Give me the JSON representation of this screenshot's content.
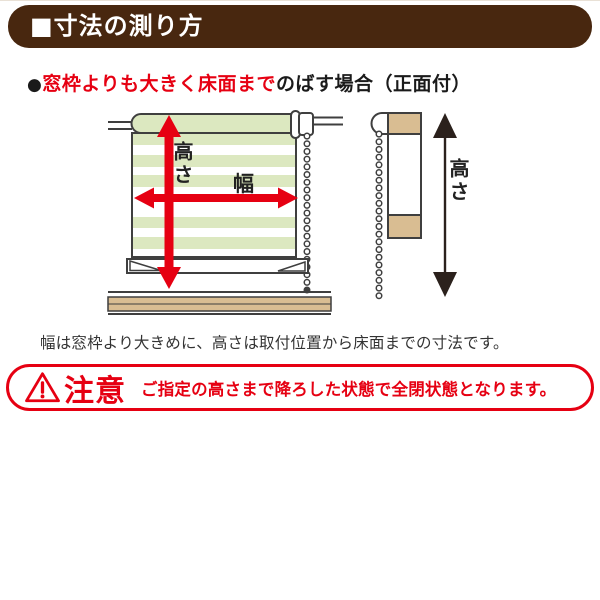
{
  "header": {
    "title": "■寸法の測り方",
    "bg_color": "#48270f",
    "text_color": "#ffffff"
  },
  "section": {
    "bullet": "●",
    "title_highlight": "窓枠よりも大きく床面まで",
    "title_rest": "のばす場合（正面付）",
    "highlight_color": "#e60012"
  },
  "diagram": {
    "front_view": {
      "height_label": "高さ",
      "width_label": "幅"
    },
    "side_view": {
      "height_label": "高さ"
    },
    "colors": {
      "arrow_red": "#e60012",
      "arrow_black": "#2b211c",
      "stripe_green": "#dce8c0",
      "wood_tan": "#d9bd92",
      "outline": "#3f3f3f"
    }
  },
  "caption": "幅は窓枠より大きめに、高さは取付位置から床面までの寸法です。",
  "warning": {
    "title": "注意",
    "message": "ご指定の高さまで降ろした状態で全閉状態となります。",
    "border_color": "#e60012"
  }
}
